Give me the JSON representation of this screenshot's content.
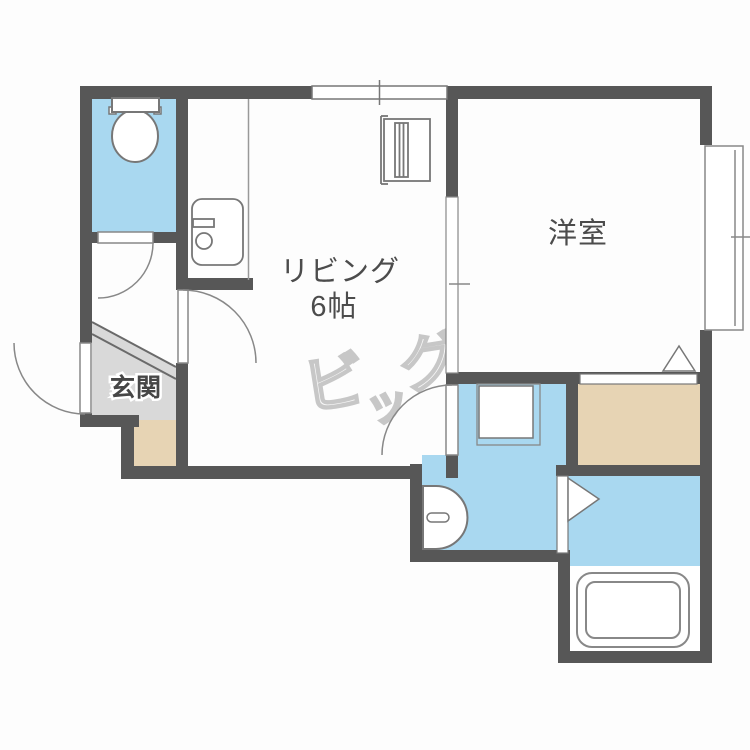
{
  "floorplan": {
    "rooms": {
      "living": {
        "name": "リビング",
        "size": "6帖"
      },
      "western": {
        "name": "洋室"
      },
      "entrance": {
        "name": "玄関"
      }
    },
    "watermark": {
      "full": "ビッグ",
      "char1": "ビ",
      "char2": "ッ",
      "char3": "グ"
    },
    "colors": {
      "wall": "#575757",
      "water_area_blue": "#a9d8f0",
      "storage_tan": "#e7d4b4",
      "entrance_gray": "#d9d9d9",
      "fixture_outline": "#777777",
      "label_text": "#4c4c4c",
      "watermark_outline": "#c7c7c7"
    },
    "fixture_icons": [
      "toilet-icon",
      "kitchen-sink-icon",
      "refrigerator-icon",
      "washing-machine-icon",
      "washbasin-icon",
      "bathtub-icon",
      "folding-door-icon",
      "door-swing-icon",
      "window-icon"
    ]
  }
}
